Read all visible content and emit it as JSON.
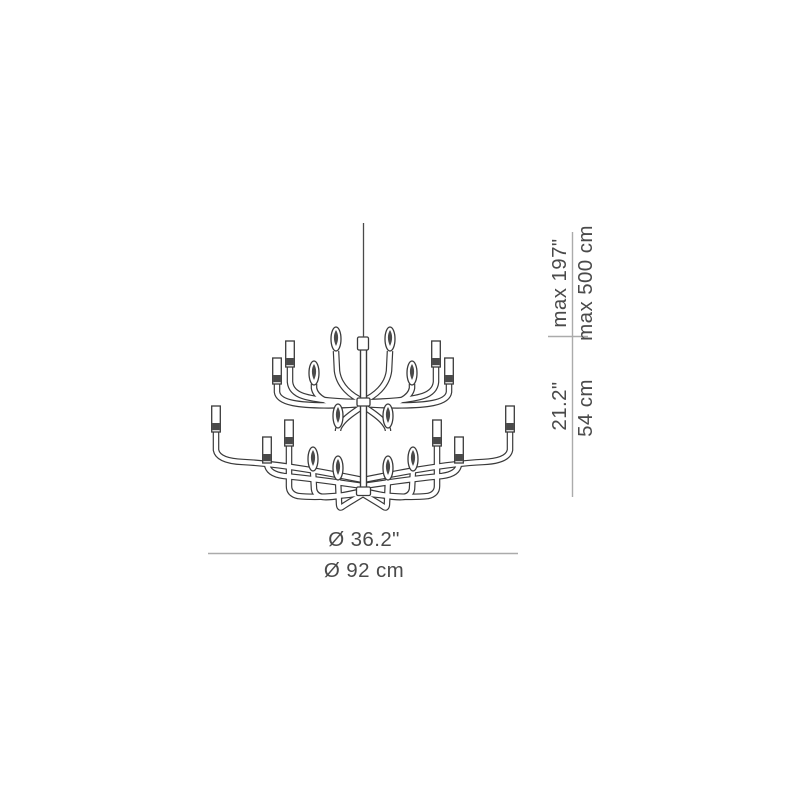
{
  "drawing": {
    "subject": "chandelier-dimension-drawing",
    "line_color": "#3a3a3a",
    "dimension_line_color": "#ababab",
    "text_color": "#4a4a4a",
    "background": "#ffffff"
  },
  "dimensions": {
    "suspension_height": {
      "inches": "max 197\"",
      "cm": "max 500 cm"
    },
    "fixture_height": {
      "inches": "21.2\"",
      "cm": "54 cm"
    },
    "diameter": {
      "inches": "Ø 36.2\"",
      "cm": "Ø 92 cm"
    }
  }
}
